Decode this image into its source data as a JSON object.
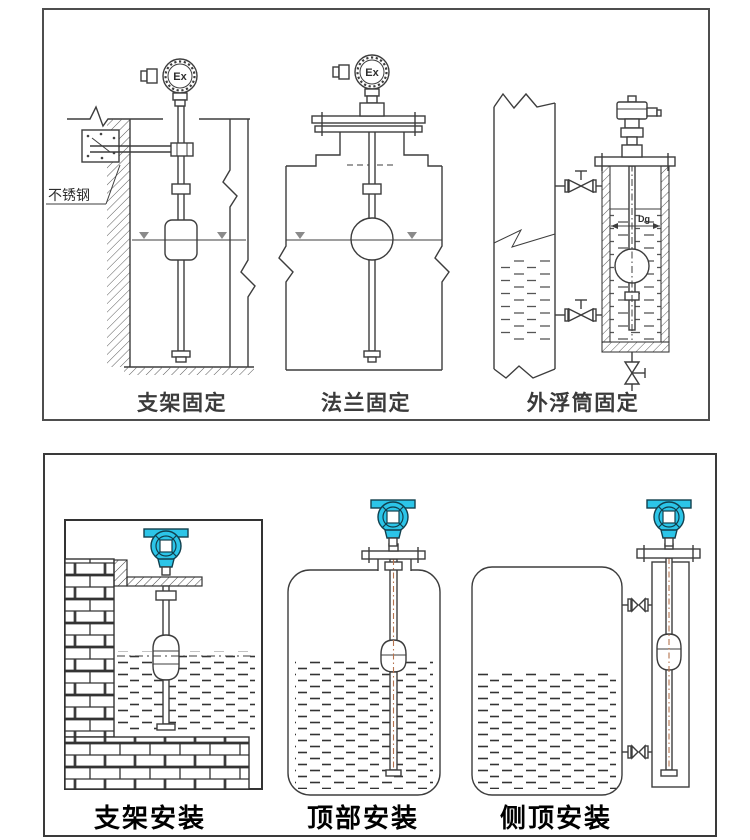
{
  "colors": {
    "line": "#3d3d3d",
    "cyan": "#2cc5e8",
    "cyan_dark": "#12404e",
    "centerline": "#b5724d"
  },
  "top_panel": {
    "captions": [
      {
        "label": "支架固定"
      },
      {
        "label": "法兰固定"
      },
      {
        "label": "外浮筒固定"
      }
    ],
    "annotations": {
      "stainless_steel": "不锈钢",
      "ex_label_left": "Ex",
      "ex_label_middle": "Ex",
      "dg_label": "Dg"
    }
  },
  "bottom_panel": {
    "captions": [
      {
        "label": "支架安装"
      },
      {
        "label": "顶部安装"
      },
      {
        "label": "侧顶安装"
      }
    ]
  }
}
